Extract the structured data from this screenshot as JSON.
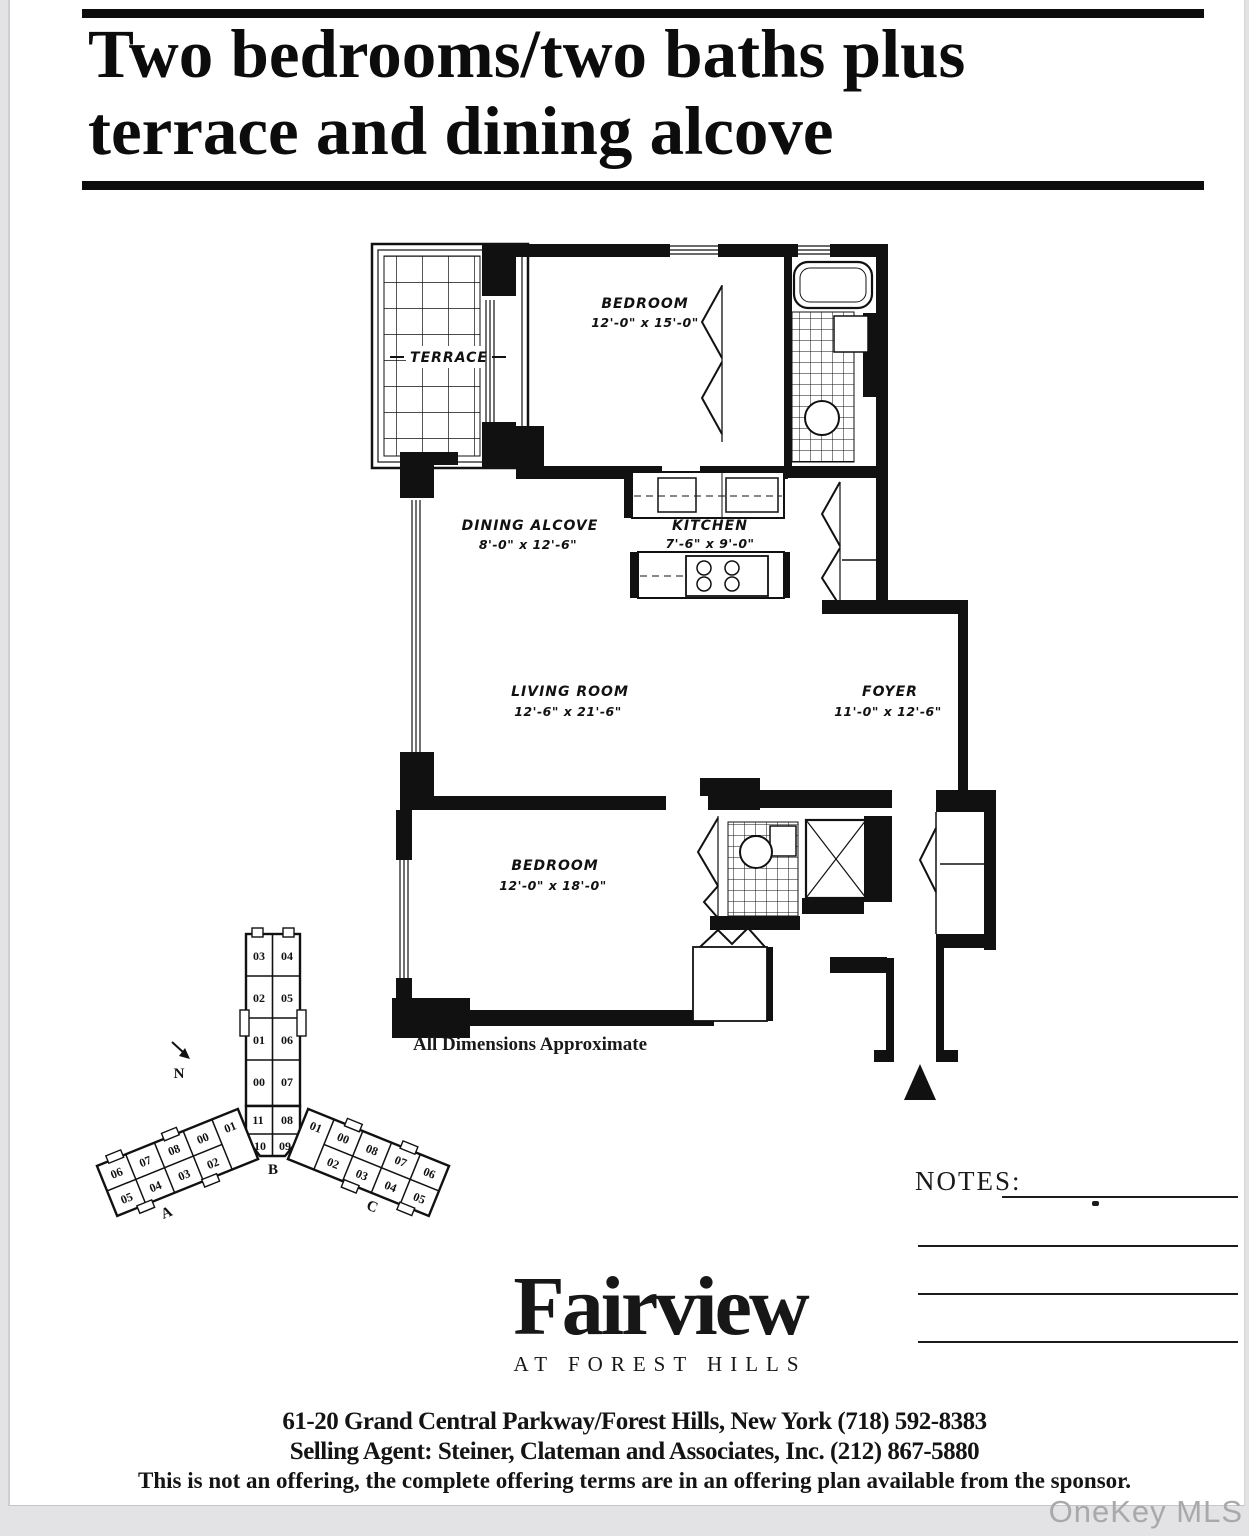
{
  "header": {
    "title_line1": "Two bedrooms/two baths plus",
    "title_line2": "terrace and dining alcove"
  },
  "floor_plan": {
    "note": "All Dimensions Approximate",
    "rooms": {
      "terrace": {
        "name": "TERRACE"
      },
      "bedroom1": {
        "name": "BEDROOM",
        "dims": "12'-0\" x 15'-0\""
      },
      "dining": {
        "name": "DINING ALCOVE",
        "dims": "8'-0\" x 12'-6\""
      },
      "kitchen": {
        "name": "KITCHEN",
        "dims": "7'-6\" x 9'-0\""
      },
      "living": {
        "name": "LIVING ROOM",
        "dims": "12'-6\" x 21'-6\""
      },
      "foyer": {
        "name": "FOYER",
        "dims": "11'-0\" x 12'-6\""
      },
      "bedroom2": {
        "name": "BEDROOM",
        "dims": "12'-0\" x 18'-0\""
      }
    }
  },
  "key_plan": {
    "north": "N",
    "wing_a": "A",
    "wing_b": "B",
    "wing_c": "C",
    "center": [
      [
        "03",
        "04"
      ],
      [
        "02",
        "05"
      ],
      [
        "01",
        "06"
      ],
      [
        "00",
        "07"
      ],
      [
        "11",
        "08"
      ],
      [
        "10",
        "09"
      ]
    ],
    "left_top": [
      "06",
      "07",
      "08",
      "00",
      "01"
    ],
    "left_bottom": [
      "05",
      "04",
      "03",
      "02"
    ],
    "right_top": [
      "01",
      "00",
      "08",
      "07",
      "06"
    ],
    "right_bottom": [
      "02",
      "03",
      "04",
      "05"
    ]
  },
  "notes": {
    "label": "NOTES:"
  },
  "branding": {
    "name": "Fairview",
    "tagline": "AT FOREST HILLS"
  },
  "footer": {
    "address": "61-20 Grand Central Parkway/Forest Hills, New York (718) 592-8383",
    "agent": "Selling Agent: Steiner, Clateman and Associates, Inc. (212) 867-5880",
    "disclaimer": "This is not an offering, the complete offering terms are in an offering plan available from the sponsor."
  },
  "watermark": {
    "text": "OneKey MLS"
  },
  "colors": {
    "ink": "#111111",
    "paper": "#ffffff",
    "page_bg": "#e3e3e6",
    "watermark": "#a9a9ac"
  }
}
